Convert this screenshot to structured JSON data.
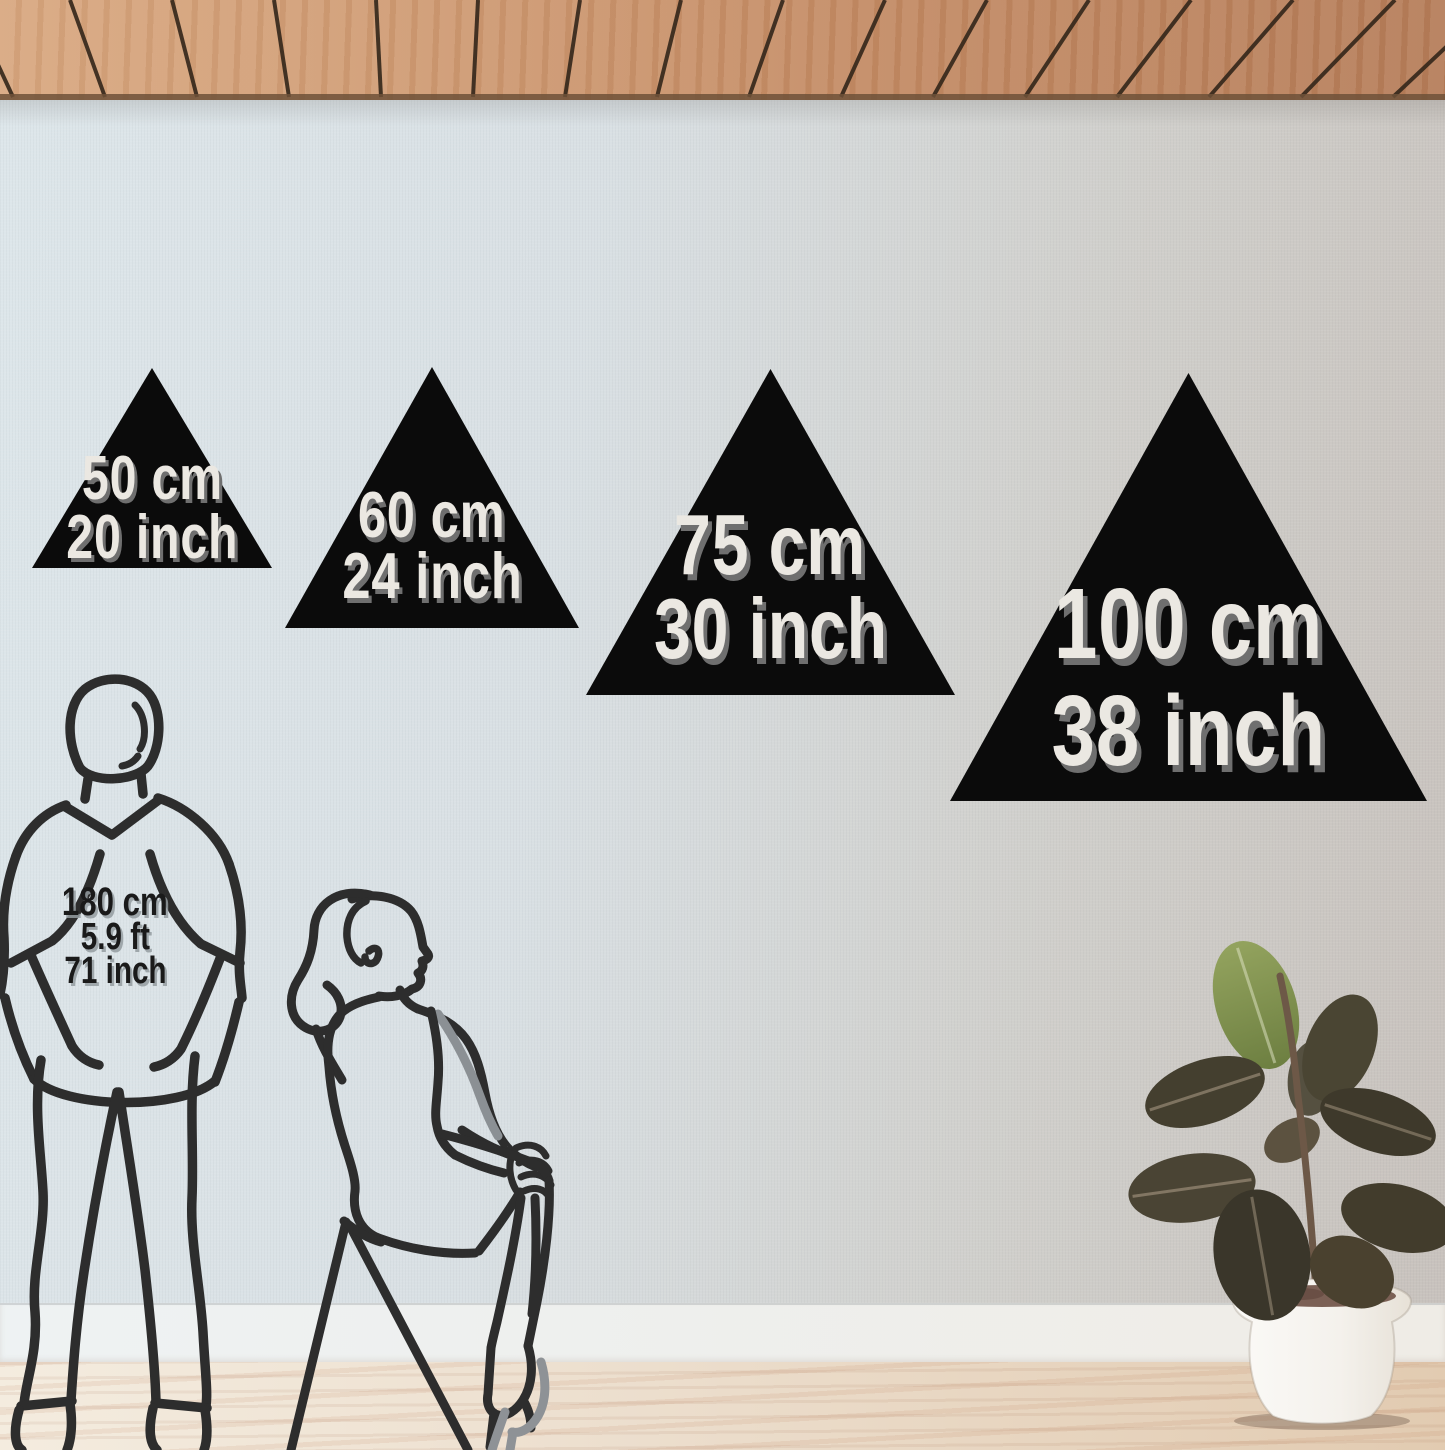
{
  "size_options": [
    {
      "metric": "50 cm",
      "imperial": "20 inch"
    },
    {
      "metric": "60 cm",
      "imperial": "24 inch"
    },
    {
      "metric": "75 cm",
      "imperial": "30 inch"
    },
    {
      "metric": "100 cm",
      "imperial": "38 inch"
    }
  ],
  "reference_person": {
    "height_metric": "180 cm",
    "height_feet": "5.9 ft",
    "height_inches": "71 inch"
  },
  "colors": {
    "triangle_fill": "#0b0b0b",
    "triangle_label": "#ebe8e2",
    "triangle_label_shadow": "#6f6f6f",
    "person_label": "#1a1a1a",
    "line_art": "#2d2d2d",
    "ceiling_wood": "#c38a63",
    "wall_left": "#dde6ea",
    "wall_right": "#c8c2bd",
    "baseboard": "#eef2f3",
    "floor_wood": "#ecdecd",
    "plant_leaf_dark": "#443f2f",
    "plant_leaf_bright": "#7f904f",
    "pot": "#f5f3ef"
  }
}
